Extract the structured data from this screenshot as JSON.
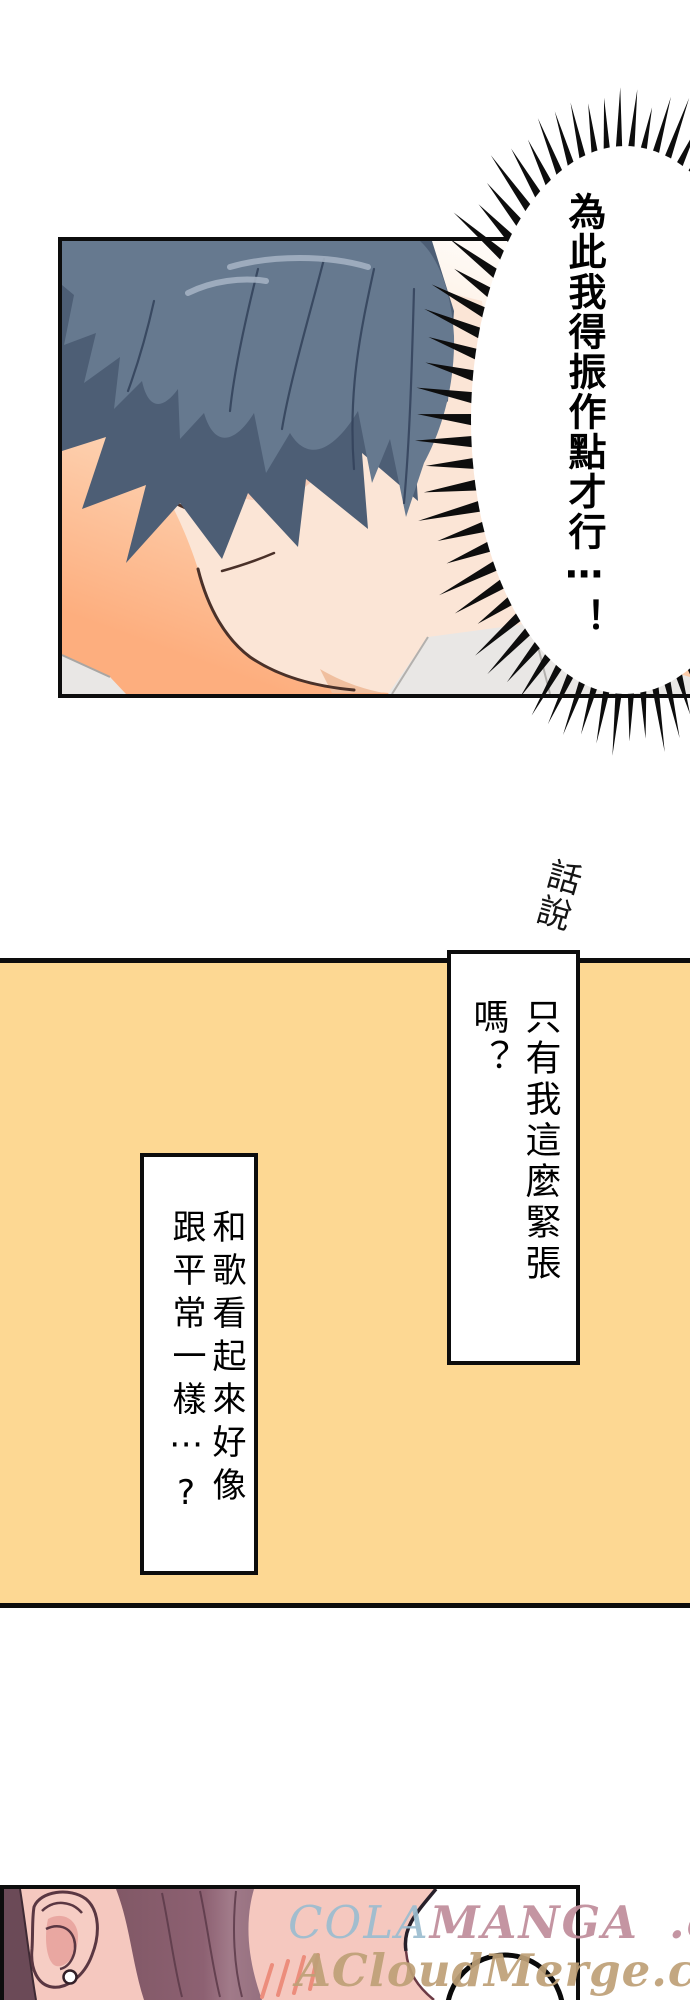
{
  "speech": {
    "shout": "為此我得振作點才行⋯！",
    "aside": "話說",
    "box_right": "只有我這麼緊張嗎？",
    "box_left": "和歌看起來好像\n跟平常一樣⋯?"
  },
  "watermark": {
    "cola": "COLA",
    "manga": "MANGA",
    "dotcom": ".com",
    "line2": "ACloudMerge.com"
  },
  "colors": {
    "inkBlack": "#0d0d0d",
    "panelYellow": "#fdd893",
    "bgOrange": "#fdae7e",
    "bgPeach": "#fde2c9",
    "hairBase": "#66798f",
    "hairShadow": "#4d5e75",
    "hairLine": "#32415a",
    "hairHighlight": "#a3b1c2",
    "skin": "#fbe5d6",
    "skinShade": "#f0bf9f",
    "faceOutline": "#4a3129",
    "eyeIris": "#c88a34",
    "eyeDark": "#3a2013",
    "blush": "#e08a76",
    "shirt": "#e9e7e5",
    "girlSkin": "#f5c8bf",
    "girlEarShade": "#e6a09b",
    "girlHair": "#8d6172",
    "girlHairDark": "#6b4a57",
    "girlHairLine": "#5c3a49",
    "girlOutline": "#5a3742",
    "girlBlush": "#ec8d7c",
    "wmBlue": "#9cbdd0",
    "wmPink": "#c08d9b",
    "wmTan": "#bea077"
  }
}
